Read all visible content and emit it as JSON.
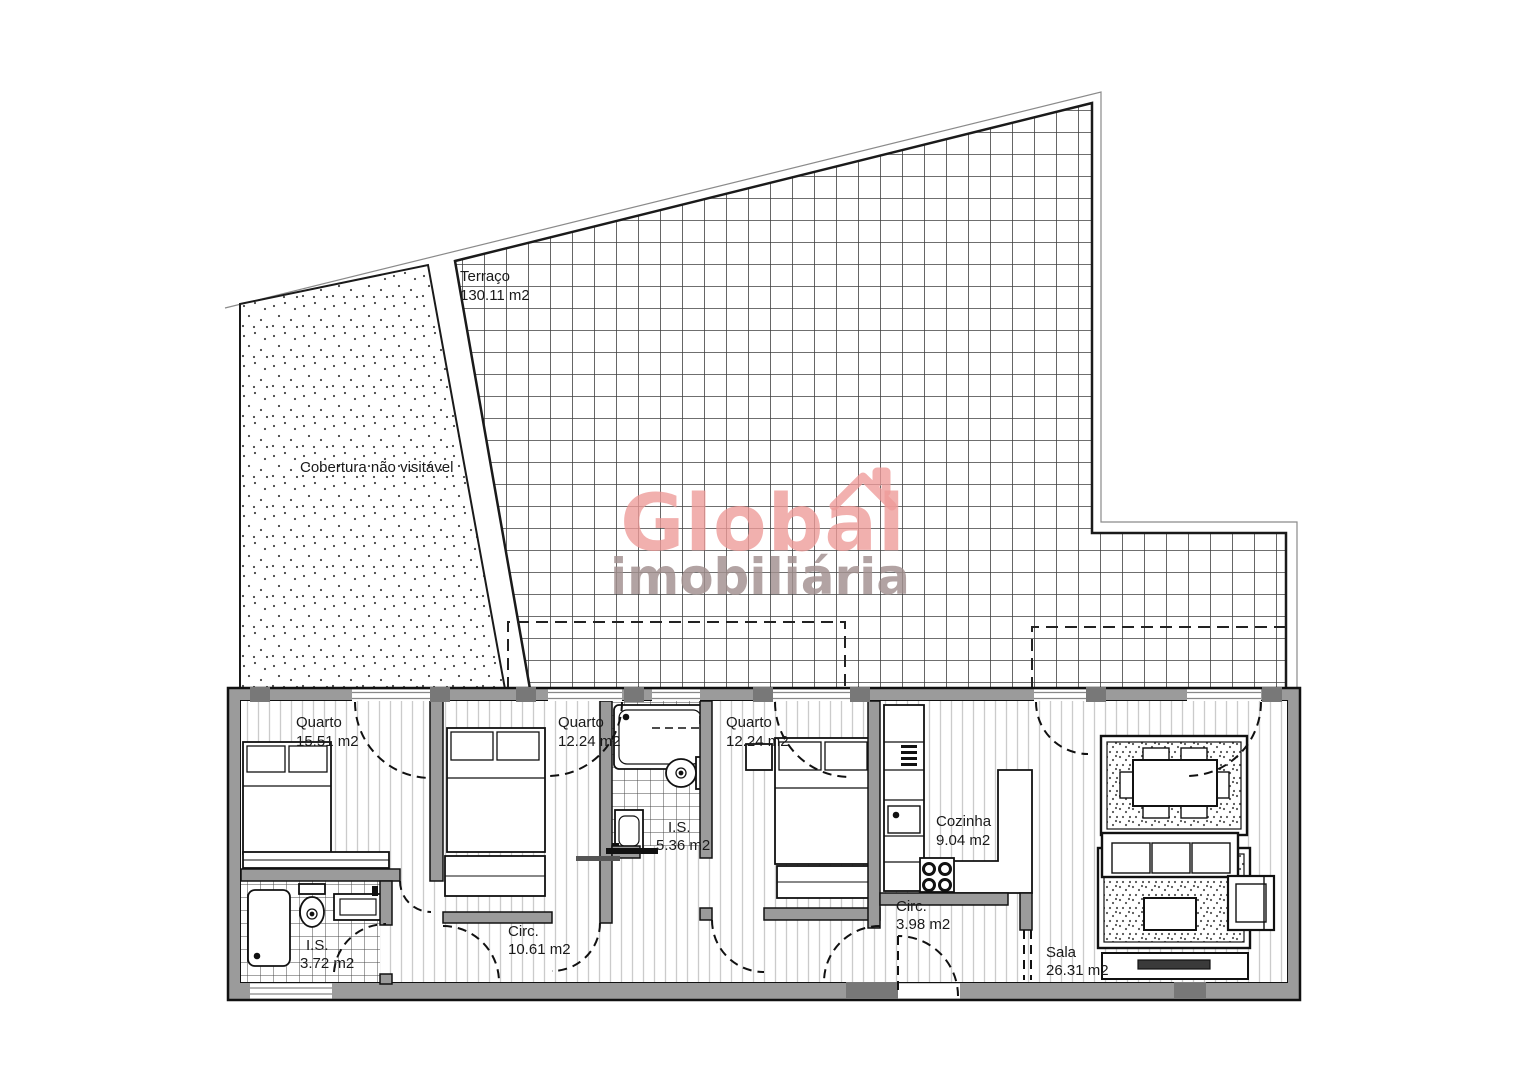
{
  "plan": {
    "watermark": {
      "line1": "Global",
      "line2": "imobiliária"
    },
    "rooms": {
      "terraco": {
        "name": "Terraço",
        "area": "130.11 m2"
      },
      "cobertura": {
        "name": "Cobertura não visitável"
      },
      "quarto1": {
        "name": "Quarto",
        "area": "15.51 m2"
      },
      "quarto2": {
        "name": "Quarto",
        "area": "12.24 m2"
      },
      "quarto3": {
        "name": "Quarto",
        "area": "12.24 m2"
      },
      "is1": {
        "name": "I.S.",
        "area": "5.36 m2"
      },
      "cozinha": {
        "name": "Cozinha",
        "area": "9.04 m2"
      },
      "circ1": {
        "name": "Circ.",
        "area": "10.61 m2"
      },
      "is2": {
        "name": "I.S.",
        "area": "3.72 m2"
      },
      "circ2": {
        "name": "Circ.",
        "area": "3.98 m2"
      },
      "sala": {
        "name": "Sala",
        "area": "26.31 m2"
      }
    },
    "colors": {
      "wall": "#9b9b9b",
      "column": "#787878",
      "line": "#111111",
      "watermark_primary": "#ee9a98",
      "watermark_secondary": "#a2908f"
    }
  }
}
